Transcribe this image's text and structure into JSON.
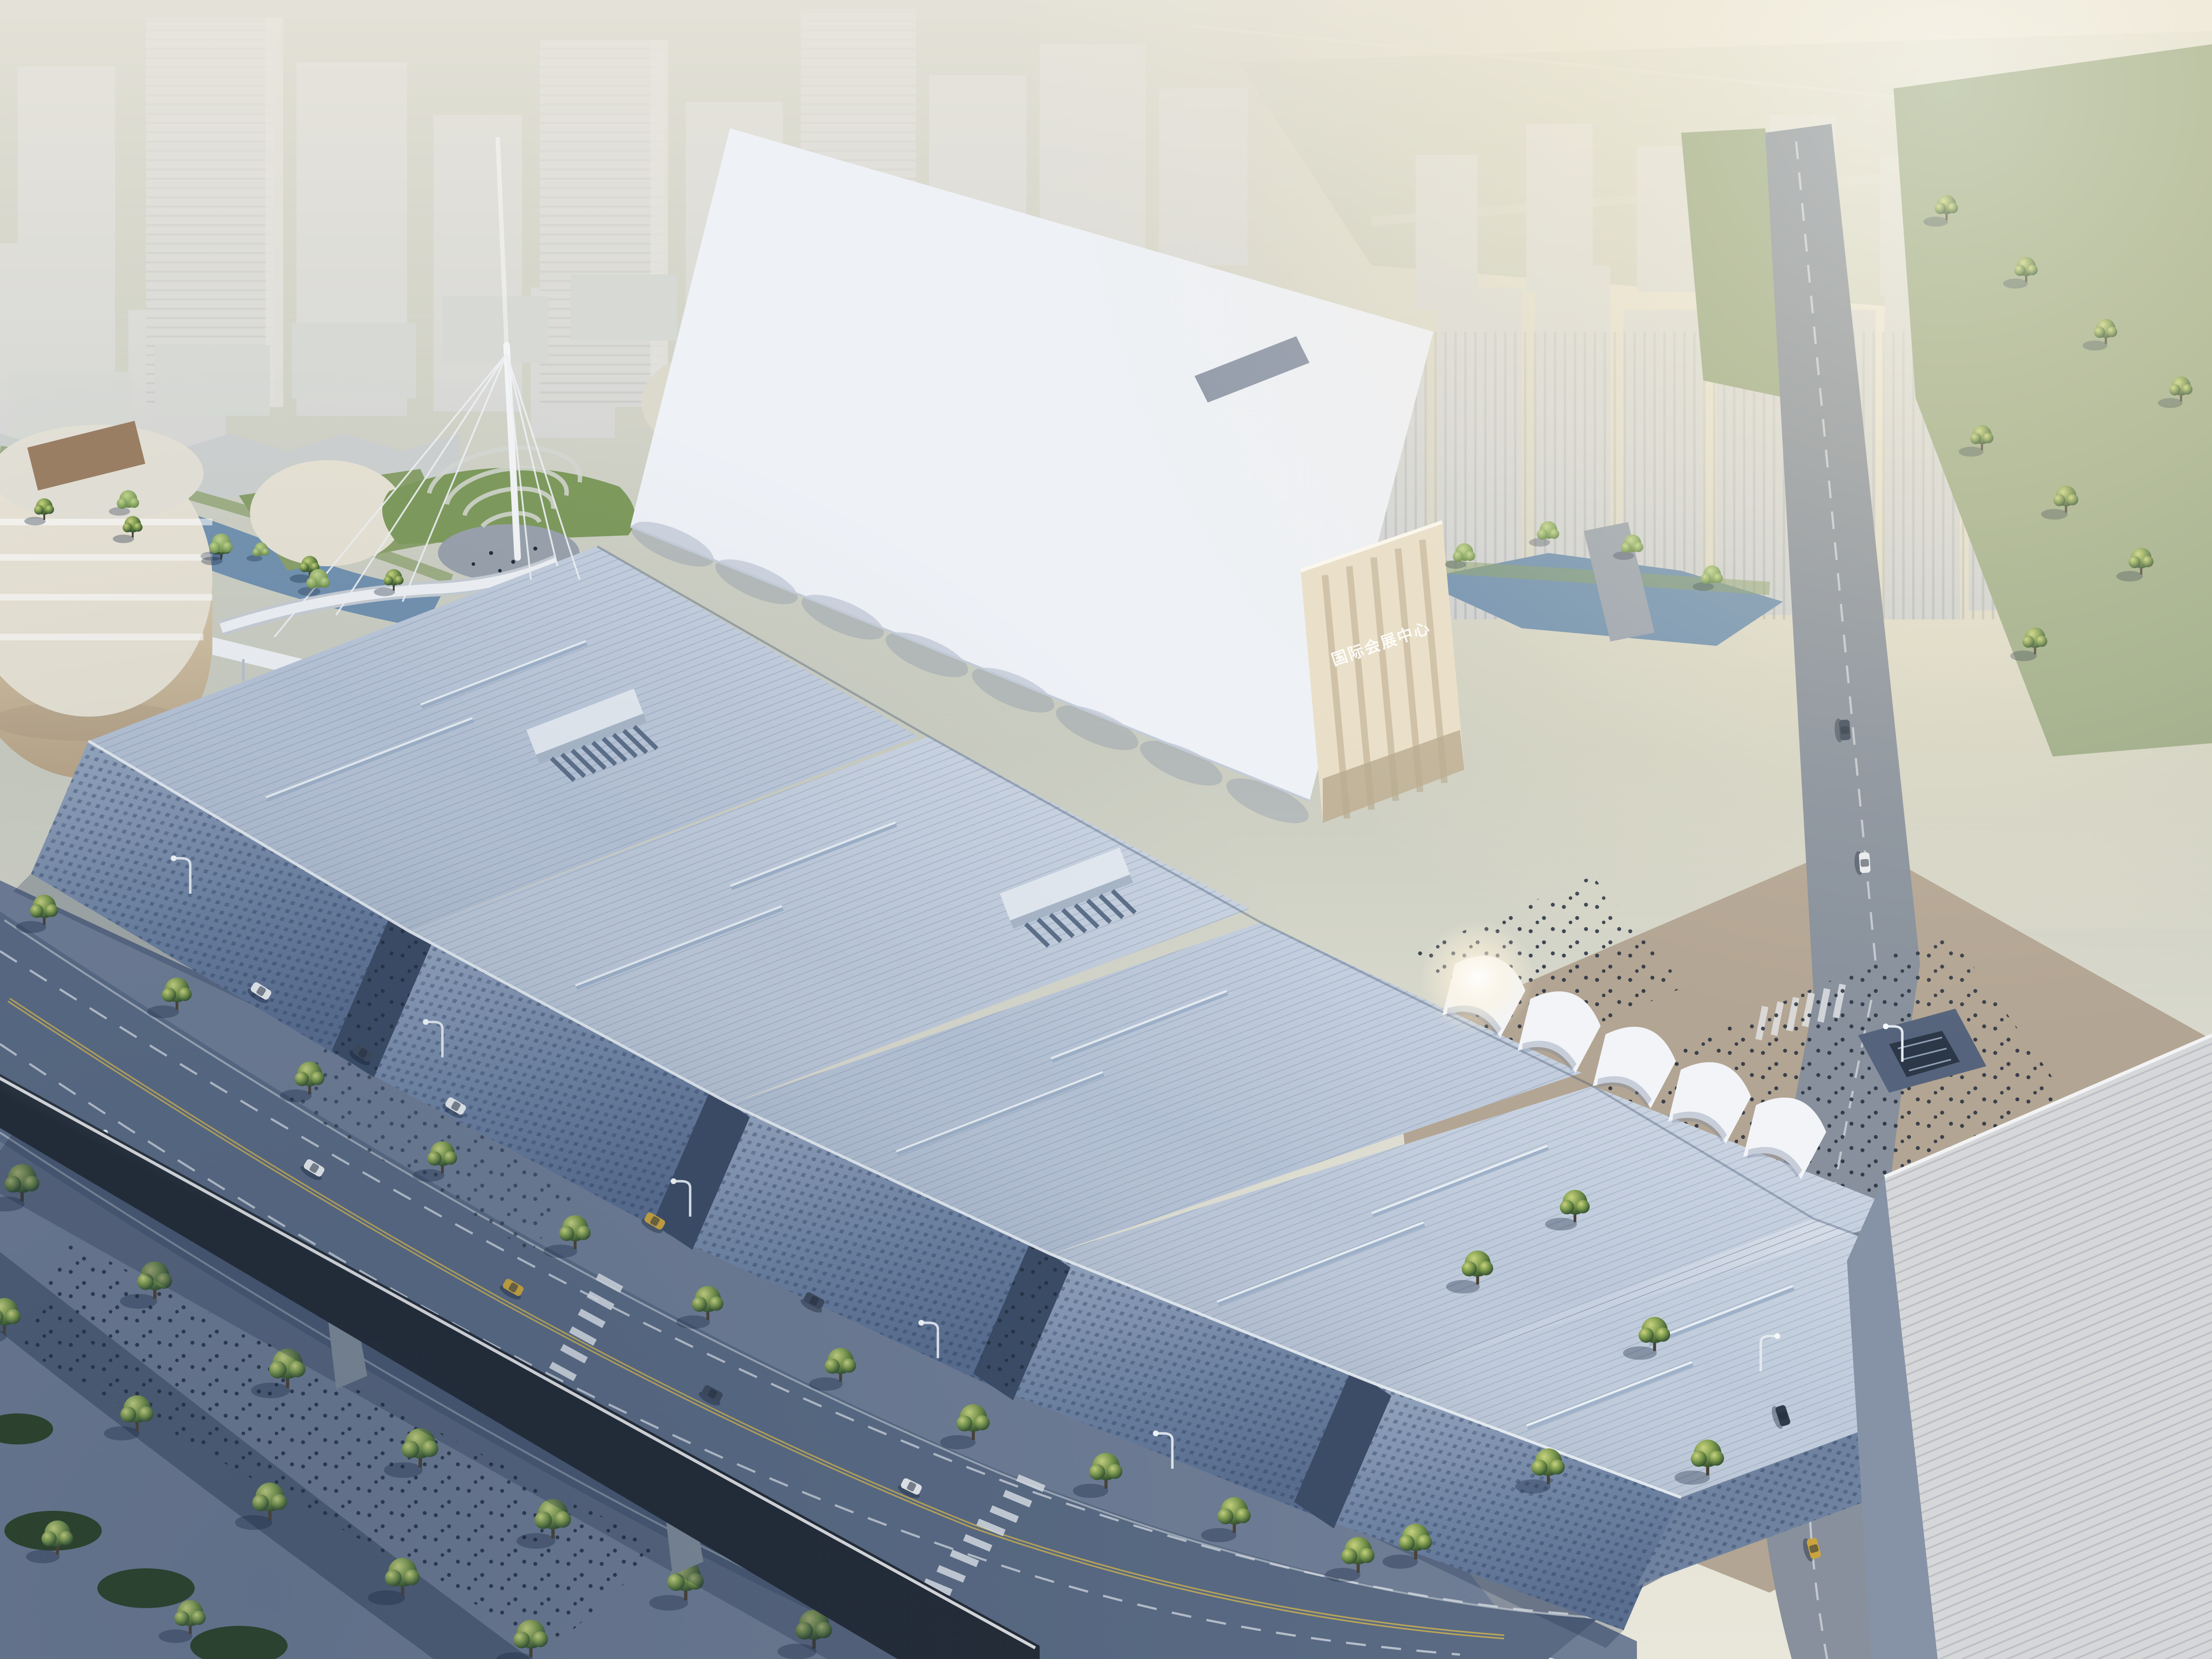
{
  "meta": {
    "description": "Aerial architectural rendering of a large international convention and exhibition center at hazy sunrise: staggered sawtooth metal-roof halls, a white tensile fabric roof hall, cable-stayed mast with amphitheater plaza, tree-lined boulevard with cars, an elevated monorail guideway, and a washed-out high-rise skyline with sun glow at upper right.",
    "time_of_day": "hazy morning, sun upper right"
  },
  "signage": {
    "building_sign": "国际会展中心"
  },
  "palette": {
    "sky_top": "#a7aea0",
    "sky_bottom": "#e9e6da",
    "sun": "#fff8e3",
    "tower": "#c7cbd0",
    "tower_shade": "#aeb3bb",
    "field": "#a3ae97",
    "lawn": "#9cab87",
    "grass": "#7e9a5c",
    "water": "#7292b0",
    "white_roof": "#eef1f6",
    "metal_roof": "#b7c4d7",
    "facade": "#8296b2",
    "canyon": "#3c4c66",
    "cream": "#e9dfc9",
    "canopy": "#f2f4f8",
    "asphalt": "#5a6a83",
    "asphalt_sun": "#87909c",
    "pavement": "#6d7a92",
    "pavement_warm": "#b3a593",
    "tree_dark": "#33502f",
    "tree_light": "#b9c878",
    "monorail": "#c6cfd9",
    "warehouse": "#d6d7d9",
    "lane_yellow": "#c4ad55",
    "people": "#232e3e"
  }
}
